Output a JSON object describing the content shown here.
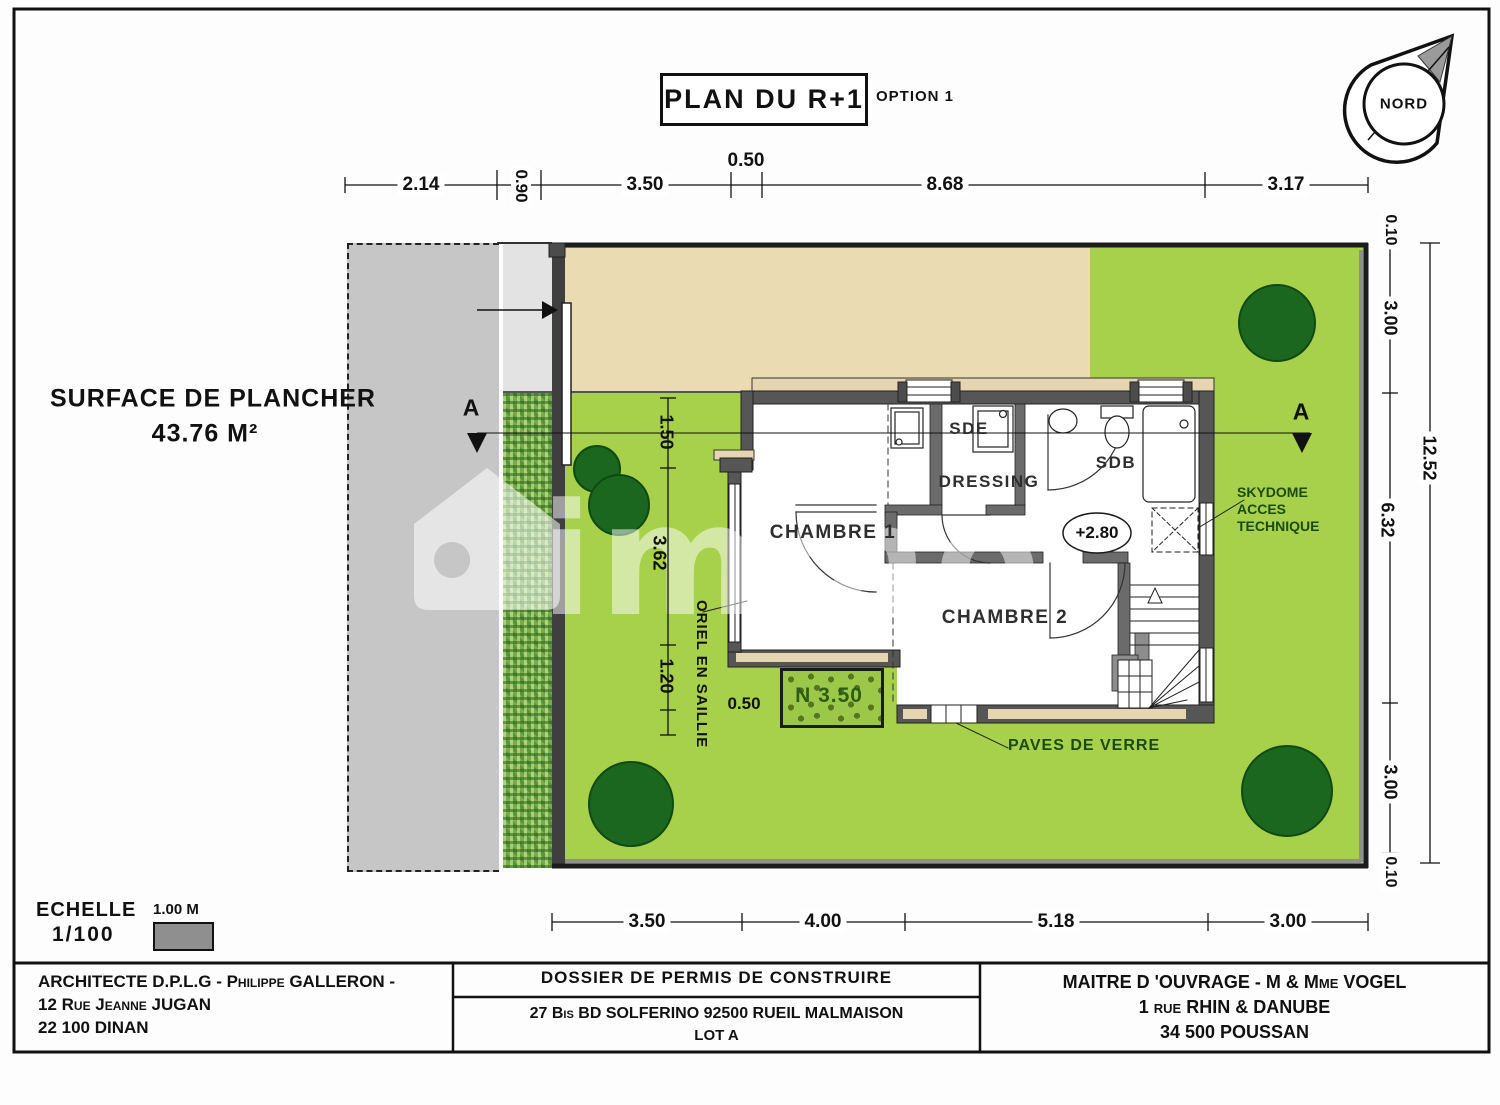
{
  "title": {
    "main": "PLAN DU R+1",
    "option": "OPTION 1"
  },
  "north": {
    "label": "NORD"
  },
  "surface": {
    "line1": "SURFACE DE PLANCHER",
    "value": "43.76 M²"
  },
  "dims": {
    "top": [
      "2.14",
      "0.90",
      "3.50",
      "0.50",
      "8.68",
      "3.17"
    ],
    "right": [
      "0.10",
      "3.00",
      "6.32",
      "3.00",
      "0.10"
    ],
    "right_total": "12.52",
    "bottom": [
      "3.50",
      "4.00",
      "5.18",
      "3.00"
    ],
    "inner_vertical": [
      "1.50",
      "3.62",
      "1.20"
    ],
    "inner_offset": "0.50"
  },
  "rooms": {
    "chambre1": "CHAMBRE 1",
    "chambre2": "CHAMBRE 2",
    "sde": "SDE",
    "dressing": "DRESSING",
    "sdb": "SDB",
    "level": "+2.80"
  },
  "annot": {
    "skydome1": "SKYDOME",
    "skydome2": "ACCES",
    "skydome3": "TECHNIQUE",
    "paves": "PAVES DE VERRE",
    "oriel": "ORIEL EN SAILLIE",
    "planter": "N 3.50",
    "section": "A"
  },
  "scalebar": {
    "echelle": "ECHELLE",
    "ratio": "1/100",
    "meter": "1.00 M"
  },
  "titleblock": {
    "architect_line1": "ARCHITECTE D.P.L.G - Philippe GALLERON -",
    "architect_line2": "12 Rue Jeanne JUGAN",
    "architect_line3": "22 100 DINAN",
    "dossier_header": "DOSSIER DE PERMIS DE CONSTRUIRE",
    "dossier_address": "27 Bis BD SOLFERINO 92500 RUEIL MALMAISON",
    "dossier_lot": "LOT A",
    "owner_line1": "MAITRE D 'OUVRAGE -  M & Mme  VOGEL",
    "owner_line2": "1 rue RHIN & DANUBE",
    "owner_line3": "34 500 POUSSAN"
  },
  "watermark": "immo",
  "colors": {
    "lawn": "#a7d04b",
    "terrace": "#ebdbb2",
    "tree": "#1c671f",
    "wall": "#565656",
    "annotation_green": "#1c4a15"
  }
}
